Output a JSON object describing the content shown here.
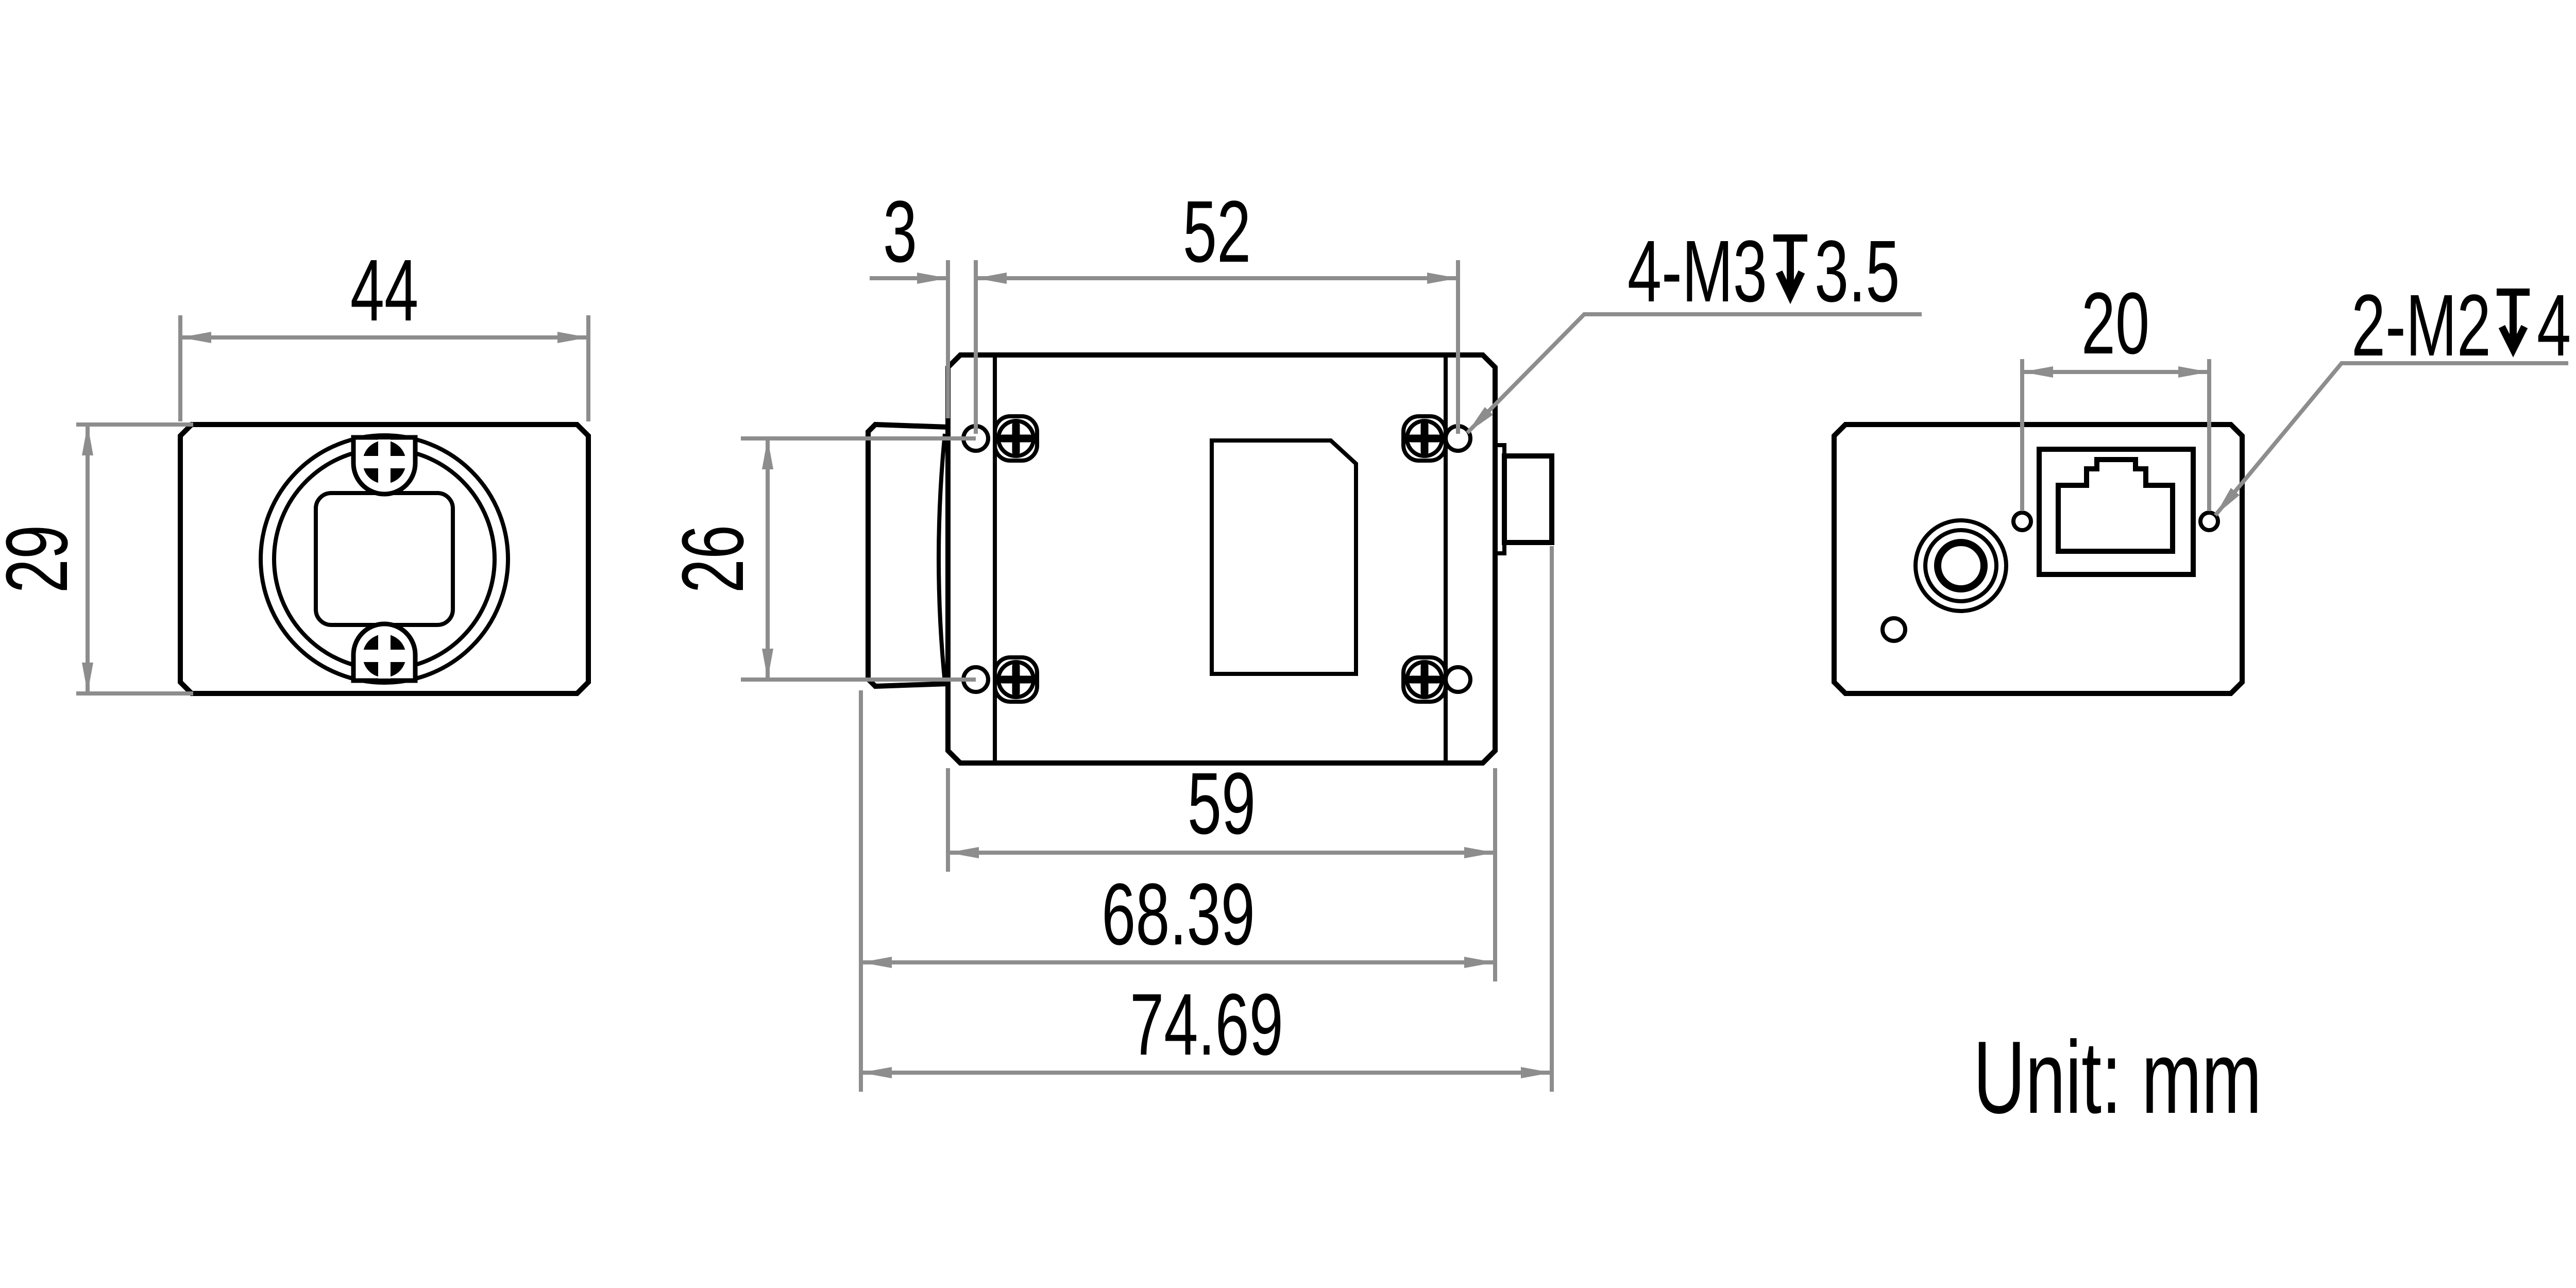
{
  "drawing": {
    "unit_label": "Unit: mm",
    "colors": {
      "outline": "#000000",
      "dimension": "#8d8d8d",
      "background": "#ffffff"
    },
    "front_view": {
      "width": "44",
      "height": "29"
    },
    "top_view": {
      "front_face_to_hole": "3",
      "hole_spacing_length": "52",
      "hole_spacing_width": "26",
      "body_length": "59",
      "length_with_lens_mount": "68.39",
      "overall_length": "74.69",
      "mount_hole_callout": {
        "prefix": "4-M3",
        "symbol": "depth",
        "value": "3.5"
      }
    },
    "back_view": {
      "hole_spacing": "20",
      "mount_hole_callout": {
        "prefix": "2-M2",
        "symbol": "depth",
        "value": "4"
      }
    }
  }
}
